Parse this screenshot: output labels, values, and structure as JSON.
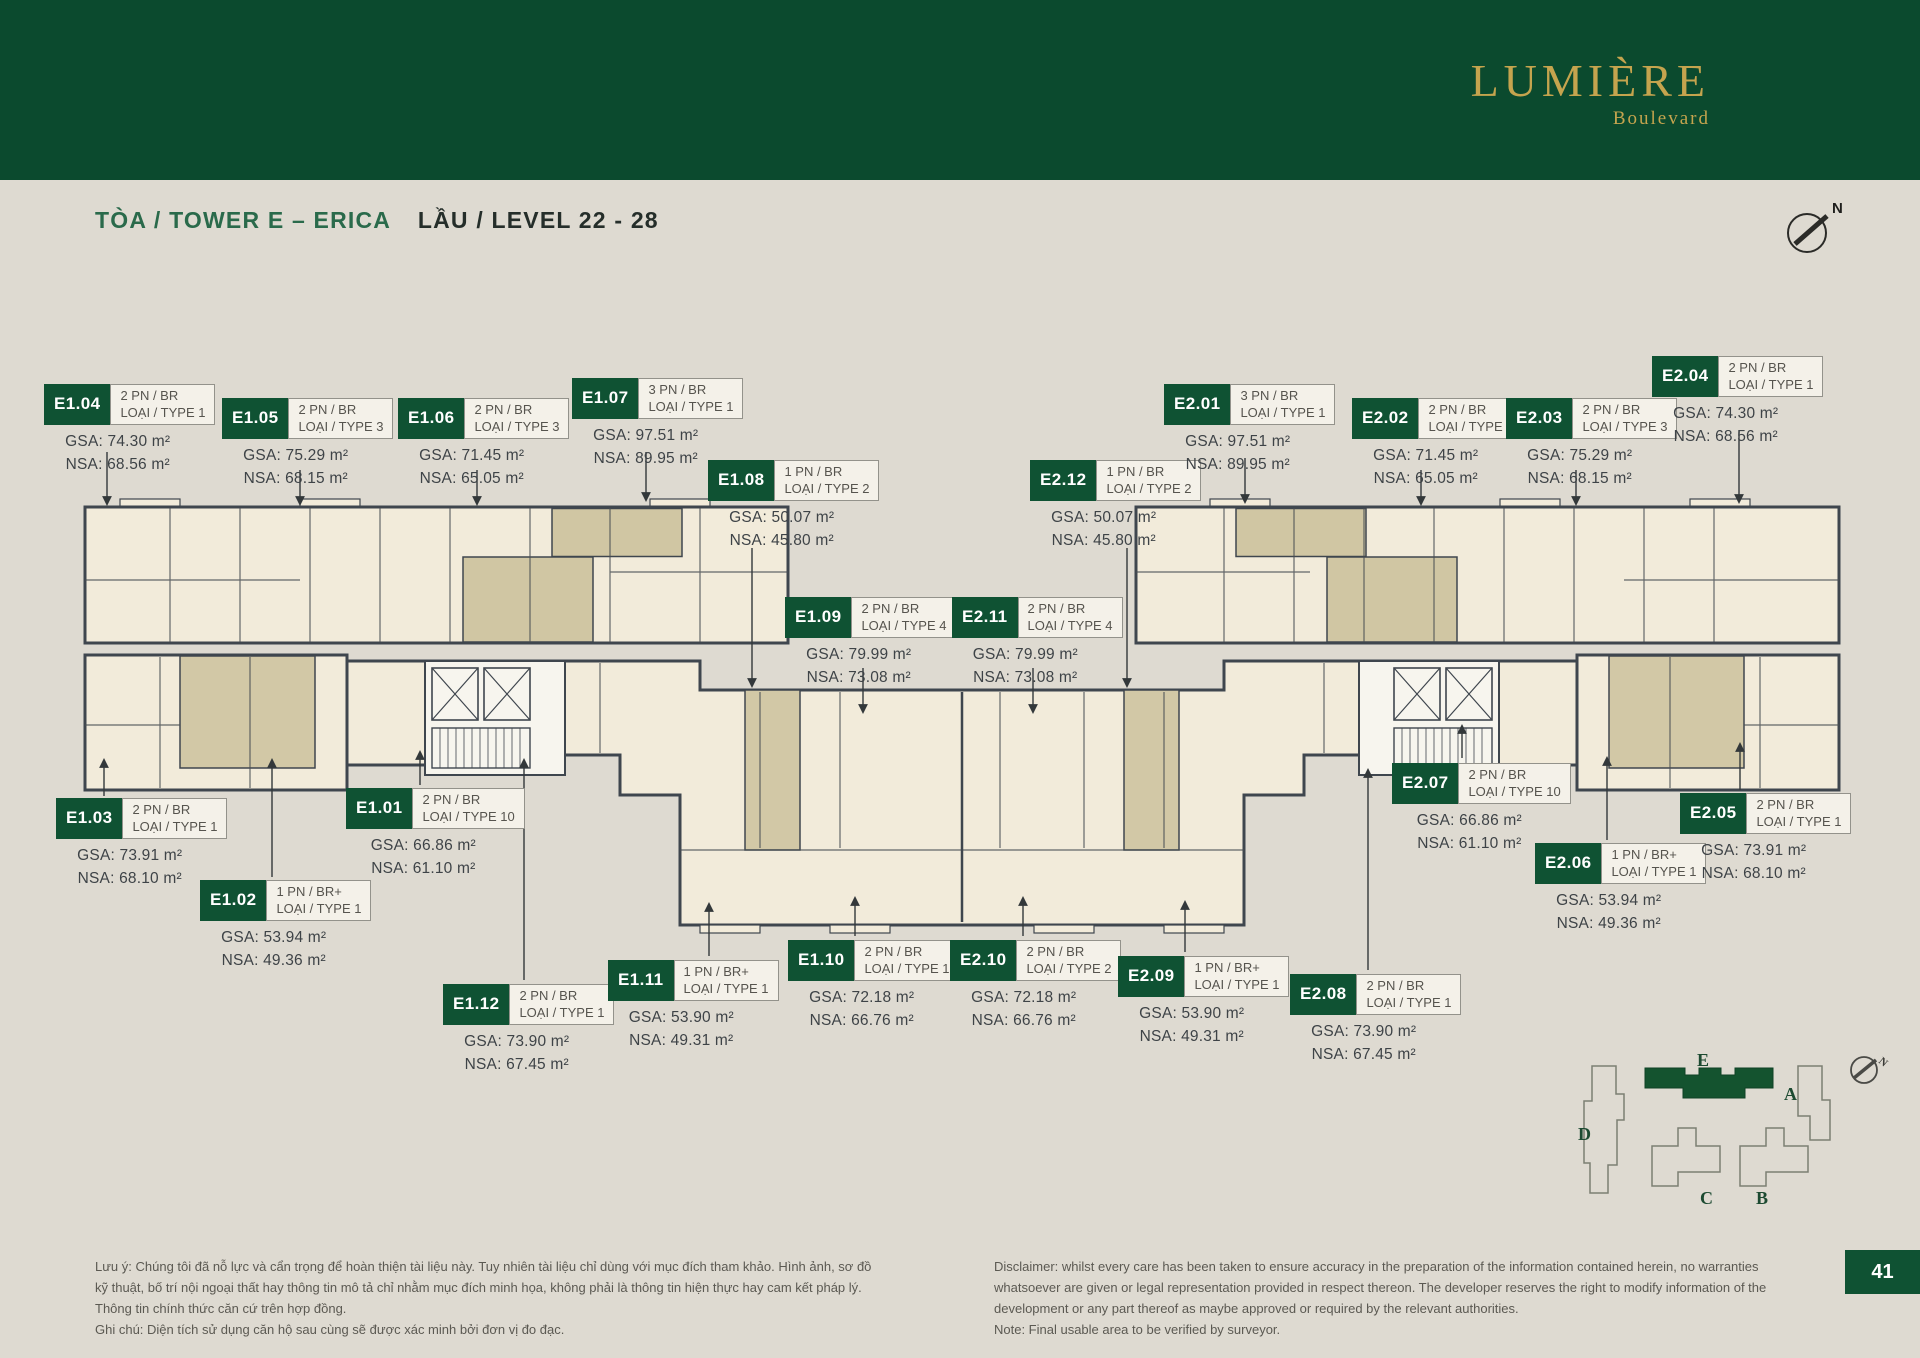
{
  "header": {
    "brand": "LUMIÈRE",
    "brand_sub": "Boulevard"
  },
  "title": {
    "tower": "TÒA / TOWER E – ERICA",
    "level": "LẦU / LEVEL 22 - 28"
  },
  "compass_n": "N",
  "units": [
    {
      "code": "E1.04",
      "type": [
        "2 PN / BR",
        "LOẠI / TYPE 1"
      ],
      "gsa": "GSA: 74.30 m²",
      "nsa": "NSA: 68.56 m²",
      "x": 44,
      "y": 384,
      "arrow": [
        107,
        452,
        107,
        504
      ]
    },
    {
      "code": "E1.05",
      "type": [
        "2 PN / BR",
        "LOẠI / TYPE 3"
      ],
      "gsa": "GSA: 75.29 m²",
      "nsa": "NSA: 68.15 m²",
      "x": 222,
      "y": 398,
      "arrow": [
        300,
        470,
        300,
        504
      ]
    },
    {
      "code": "E1.06",
      "type": [
        "2 PN / BR",
        "LOẠI / TYPE 3"
      ],
      "gsa": "GSA: 71.45 m²",
      "nsa": "NSA: 65.05 m²",
      "x": 398,
      "y": 398,
      "arrow": [
        477,
        470,
        477,
        504
      ]
    },
    {
      "code": "E1.07",
      "type": [
        "3 PN / BR",
        "LOẠI / TYPE 1"
      ],
      "gsa": "GSA: 97.51 m²",
      "nsa": "NSA: 89.95 m²",
      "x": 572,
      "y": 378,
      "arrow": [
        646,
        452,
        646,
        500
      ]
    },
    {
      "code": "E1.08",
      "type": [
        "1 PN / BR",
        "LOẠI / TYPE 2"
      ],
      "gsa": "GSA: 50.07 m²",
      "nsa": "NSA: 45.80 m²",
      "x": 708,
      "y": 460,
      "arrow": [
        752,
        548,
        752,
        686
      ]
    },
    {
      "code": "E1.09",
      "type": [
        "2 PN / BR",
        "LOẠI / TYPE 4"
      ],
      "gsa": "GSA: 79.99 m²",
      "nsa": "NSA: 73.08 m²",
      "x": 785,
      "y": 597,
      "arrow": [
        863,
        668,
        863,
        712
      ]
    },
    {
      "code": "E2.11",
      "type": [
        "2 PN / BR",
        "LOẠI / TYPE 4"
      ],
      "gsa": "GSA: 79.99 m²",
      "nsa": "NSA: 73.08 m²",
      "x": 952,
      "y": 597,
      "arrow": [
        1033,
        668,
        1033,
        712
      ]
    },
    {
      "code": "E2.12",
      "type": [
        "1 PN / BR",
        "LOẠI / TYPE 2"
      ],
      "gsa": "GSA: 50.07 m²",
      "nsa": "NSA: 45.80 m²",
      "x": 1030,
      "y": 460,
      "arrow": [
        1127,
        548,
        1127,
        686
      ]
    },
    {
      "code": "E2.01",
      "type": [
        "3 PN / BR",
        "LOẠI / TYPE 1"
      ],
      "gsa": "GSA: 97.51 m²",
      "nsa": "NSA: 89.95 m²",
      "x": 1164,
      "y": 384,
      "arrow": [
        1245,
        458,
        1245,
        502
      ]
    },
    {
      "code": "E2.02",
      "type": [
        "2 PN / BR",
        "LOẠI / TYPE 3"
      ],
      "gsa": "GSA: 71.45 m²",
      "nsa": "NSA: 65.05 m²",
      "x": 1352,
      "y": 398,
      "arrow": [
        1421,
        470,
        1421,
        504
      ]
    },
    {
      "code": "E2.03",
      "type": [
        "2 PN / BR",
        "LOẠI / TYPE 3"
      ],
      "gsa": "GSA: 75.29 m²",
      "nsa": "NSA: 68.15 m²",
      "x": 1506,
      "y": 398,
      "arrow": [
        1576,
        470,
        1576,
        504
      ]
    },
    {
      "code": "E2.04",
      "type": [
        "2 PN / BR",
        "LOẠI / TYPE 1"
      ],
      "gsa": "GSA: 74.30 m²",
      "nsa": "NSA: 68.56 m²",
      "x": 1652,
      "y": 356,
      "arrow": [
        1739,
        430,
        1739,
        502
      ]
    },
    {
      "code": "E1.03",
      "type": [
        "2 PN / BR",
        "LOẠI / TYPE 1"
      ],
      "gsa": "GSA: 73.91 m²",
      "nsa": "NSA: 68.10 m²",
      "x": 56,
      "y": 798,
      "arrow": [
        104,
        796,
        104,
        760
      ]
    },
    {
      "code": "E1.02",
      "type": [
        "1 PN / BR+",
        "LOẠI / TYPE 1"
      ],
      "gsa": "GSA: 53.94 m²",
      "nsa": "NSA: 49.36 m²",
      "x": 200,
      "y": 880,
      "arrow": [
        272,
        877,
        272,
        760
      ]
    },
    {
      "code": "E1.01",
      "type": [
        "2 PN / BR",
        "LOẠI / TYPE 10"
      ],
      "gsa": "GSA: 66.86 m²",
      "nsa": "NSA: 61.10 m²",
      "x": 346,
      "y": 788,
      "arrow": [
        420,
        785,
        420,
        752
      ]
    },
    {
      "code": "E1.12",
      "type": [
        "2 PN / BR",
        "LOẠI / TYPE 1"
      ],
      "gsa": "GSA: 73.90 m²",
      "nsa": "NSA: 67.45 m²",
      "x": 443,
      "y": 984,
      "arrow": [
        524,
        980,
        524,
        760
      ]
    },
    {
      "code": "E1.11",
      "type": [
        "1 PN / BR+",
        "LOẠI / TYPE 1"
      ],
      "gsa": "GSA: 53.90 m²",
      "nsa": "NSA: 49.31 m²",
      "x": 608,
      "y": 960,
      "arrow": [
        709,
        956,
        709,
        904
      ]
    },
    {
      "code": "E1.10",
      "type": [
        "2 PN / BR",
        "LOẠI / TYPE 1"
      ],
      "gsa": "GSA: 72.18 m²",
      "nsa": "NSA: 66.76 m²",
      "x": 788,
      "y": 940,
      "arrow": [
        855,
        936,
        855,
        898
      ]
    },
    {
      "code": "E2.10",
      "type": [
        "2 PN / BR",
        "LOẠI / TYPE 2"
      ],
      "gsa": "GSA: 72.18 m²",
      "nsa": "NSA: 66.76 m²",
      "x": 950,
      "y": 940,
      "arrow": [
        1023,
        936,
        1023,
        898
      ]
    },
    {
      "code": "E2.09",
      "type": [
        "1 PN / BR+",
        "LOẠI / TYPE 1"
      ],
      "gsa": "GSA: 53.90 m²",
      "nsa": "NSA: 49.31 m²",
      "x": 1118,
      "y": 956,
      "arrow": [
        1185,
        952,
        1185,
        902
      ]
    },
    {
      "code": "E2.08",
      "type": [
        "2 PN / BR",
        "LOẠI / TYPE 1"
      ],
      "gsa": "GSA: 73.90 m²",
      "nsa": "NSA: 67.45 m²",
      "x": 1290,
      "y": 974,
      "arrow": [
        1368,
        970,
        1368,
        770
      ]
    },
    {
      "code": "E2.07",
      "type": [
        "2 PN / BR",
        "LOẠI / TYPE 10"
      ],
      "gsa": "GSA: 66.86 m²",
      "nsa": "NSA: 61.10 m²",
      "x": 1392,
      "y": 763,
      "arrow": [
        1462,
        758,
        1462,
        726
      ]
    },
    {
      "code": "E2.06",
      "type": [
        "1 PN / BR+",
        "LOẠI / TYPE 1"
      ],
      "gsa": "GSA: 53.94 m²",
      "nsa": "NSA: 49.36 m²",
      "x": 1535,
      "y": 843,
      "arrow": [
        1607,
        840,
        1607,
        758
      ]
    },
    {
      "code": "E2.05",
      "type": [
        "2 PN / BR",
        "LOẠI / TYPE 1"
      ],
      "gsa": "GSA: 73.91 m²",
      "nsa": "NSA: 68.10 m²",
      "x": 1680,
      "y": 793,
      "arrow": [
        1740,
        790,
        1740,
        744
      ]
    }
  ],
  "minimap": {
    "labels": {
      "a": "A",
      "b": "B",
      "c": "C",
      "d": "D",
      "e": "E"
    },
    "compass_n": "N",
    "highlight": "E"
  },
  "footer": {
    "vi": "Lưu ý: Chúng tôi đã nỗ lực và cẩn trọng để hoàn thiện tài liệu này. Tuy nhiên tài liệu chỉ dùng với mục đích tham khảo. Hình ảnh, sơ đồ\nkỹ thuật, bố trí nội ngoại thất hay thông tin mô tả chỉ nhằm mục đích minh họa, không phải là thông tin hiện thực hay cam kết pháp lý.\nThông tin chính thức căn cứ trên hợp đồng.\nGhi chú: Diện tích sử dụng căn hộ sau cùng sẽ được xác minh bởi đơn vị đo đạc.",
    "en": "Disclaimer: whilst every care has been taken to ensure accuracy in the preparation of the information contained herein, no warranties\nwhatsoever are given or legal representation provided in respect thereon. The developer reserves the right to modify information of the\ndevelopment or any part thereof as maybe approved or required by the relevant authorities.\nNote: Final usable area to be verified by surveyor.",
    "page_number": "41"
  },
  "colors": {
    "header_green": "#0b4a2e",
    "label_green": "#0f5233",
    "gold": "#c5a44e",
    "background": "#dedad1",
    "cream": "#f2ebda",
    "khaki": "#d2c8a6",
    "wall": "#3f464e"
  }
}
